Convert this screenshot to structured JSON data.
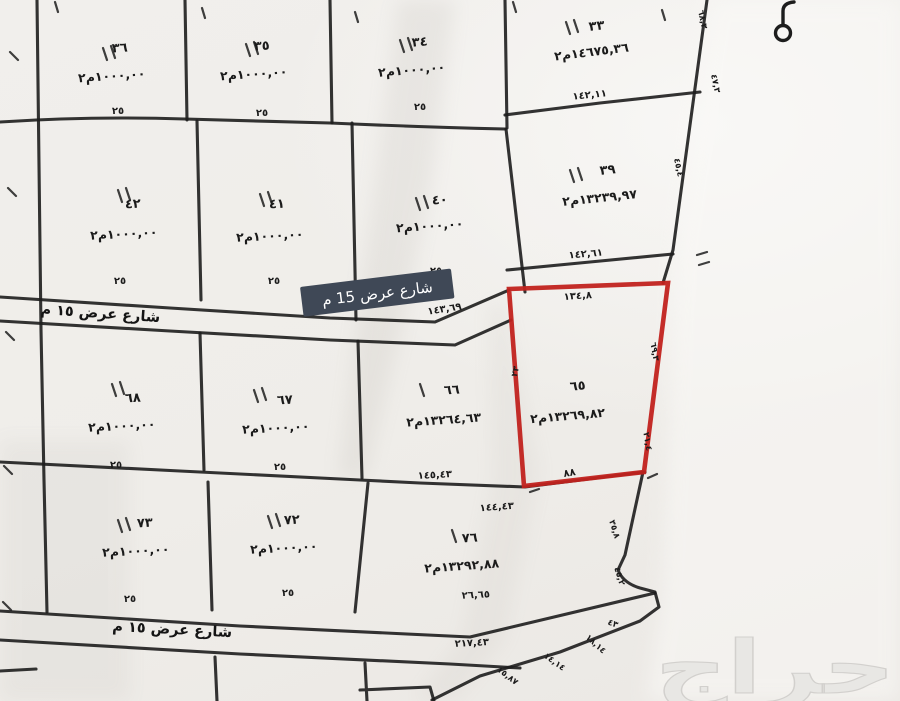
{
  "map": {
    "title_note": "مخطط أراضي - صك مساحي",
    "street_badge": "شارع عرض 15 م",
    "street_hand_top": "شارع عرض ١٥ م",
    "street_hand_bottom": "شارع عرض ١٥ م",
    "watermark": "حراج",
    "colors": {
      "highlight_red": "#c1221d",
      "badge_bg": "#3f4856",
      "line": "#1d1d1d",
      "paper": "#f0eeea",
      "watermark_gray": "#e8e7e4"
    },
    "plots": {
      "p36": {
        "no": "٣٦",
        "area": "١٠٠٠,٠٠م٢",
        "width": "٢٥"
      },
      "p35": {
        "no": "٣٥",
        "area": "١٠٠٠,٠٠م٢",
        "width": "٢٥"
      },
      "p34": {
        "no": "٣٤",
        "area": "١٠٠٠,٠٠م٢",
        "width": "٢٥"
      },
      "p33": {
        "no": "٣٣",
        "area": "١٤٦٧٥,٣٦م٢",
        "edge": "١٤٢,١١"
      },
      "p42": {
        "no": "٤٢",
        "area": "١٠٠٠,٠٠م٢",
        "width": "٢٥"
      },
      "p41": {
        "no": "٤١",
        "area": "١٠٠٠,٠٠م٢",
        "width": "٢٥"
      },
      "p40": {
        "no": "٤٠",
        "area": "١٠٠٠,٠٠م٢",
        "width": "٢٥"
      },
      "p39": {
        "no": "٣٩",
        "area": "١٣٢٣٩,٩٧م٢",
        "edge": "١٤٢,٦١"
      },
      "p68": {
        "no": "٦٨",
        "area": "١٠٠٠,٠٠م٢",
        "width": "٢٥"
      },
      "p67": {
        "no": "٦٧",
        "area": "١٠٠٠,٠٠م٢",
        "width": "٢٥"
      },
      "p66": {
        "no": "٦٦",
        "area": "١٣٢٦٤,٦٣م٢"
      },
      "p65": {
        "no": "٦٥",
        "area": "١٣٢٦٩,٨٢م٢",
        "highlighted": true,
        "top_edge": "١٣٤,٨",
        "right_edge": "٦٩,٣",
        "right_edge2": "٢١,٤",
        "left_edge": "٢٣",
        "bottom_note": "٨٨"
      },
      "p73": {
        "no": "٧٣",
        "area": "١٠٠٠,٠٠م٢",
        "width": "٢٥"
      },
      "p72": {
        "no": "٧٢",
        "area": "١٠٠٠,٠٠م٢",
        "width": "٢٥"
      },
      "p76": {
        "no": "٧٦",
        "area": "١٣٢٩٢,٨٨م٢",
        "edge": "٢٦,٦٥"
      }
    },
    "dimensions": {
      "street1_len": "١٤٣,٦٩",
      "row3_seg_a": "١٤٥,٤٣",
      "row3_seg_b": "١٤٤,٤٣",
      "street2_len": "٢١٧,٤٣",
      "diag_1": "١٥,٨٧",
      "diag_2": "١٤,١٤",
      "diag_3": "١٨,١٤",
      "diag_4": "٤٣",
      "east_1": "٦٨,٣",
      "east_2": "٤٧,٣",
      "east_3": "٤٥,٤",
      "east_4": "٣٥,٨",
      "east_5": "٤٥,٢"
    }
  }
}
